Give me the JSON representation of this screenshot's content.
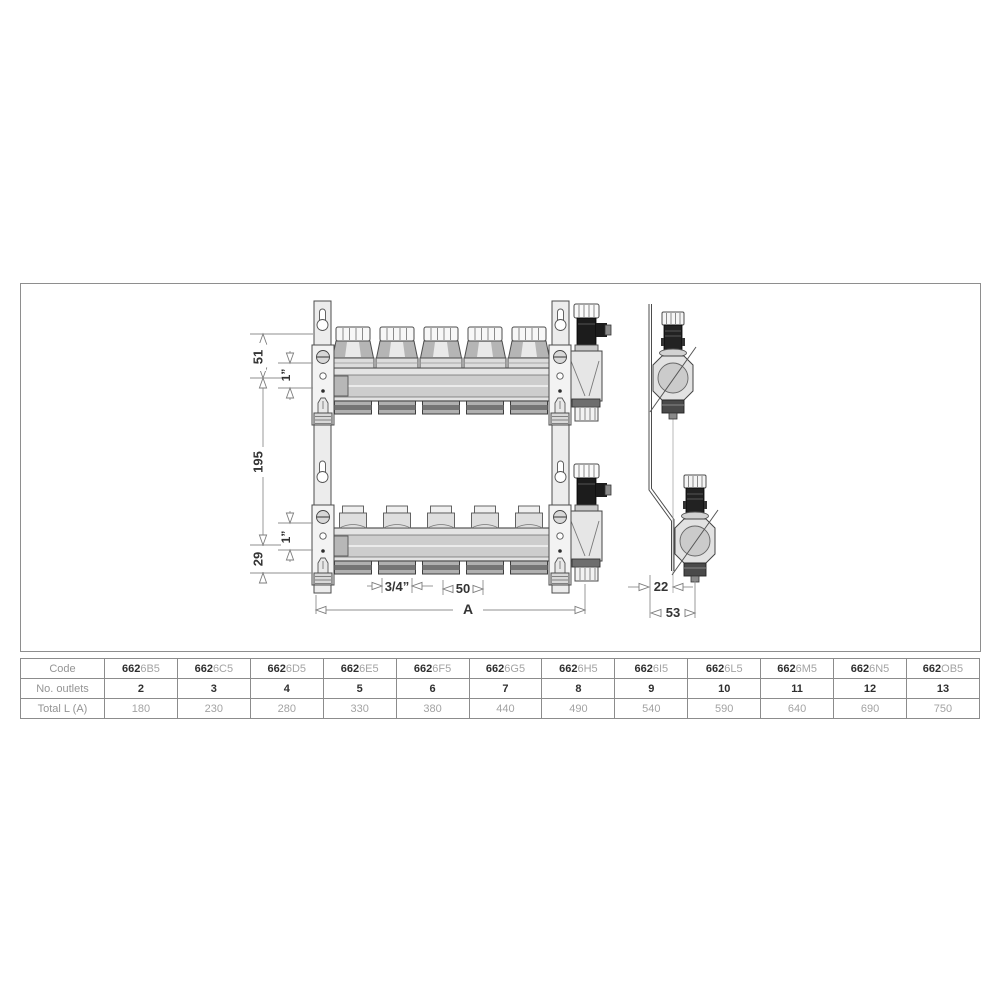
{
  "drawing": {
    "dims": {
      "d51": "51",
      "d1_top": "1”",
      "d195": "195",
      "d29": "29",
      "d1_bottom": "1”",
      "d34": "3/4”",
      "d50": "50",
      "dA": "A",
      "d22": "22",
      "d53": "53"
    }
  },
  "table": {
    "row_labels": {
      "code": "Code",
      "outlets": "No. outlets",
      "total": "Total L (A)"
    },
    "code_prefix": "662",
    "columns": [
      {
        "code_suffix": "6B5",
        "outlets": "2",
        "total": "180"
      },
      {
        "code_suffix": "6C5",
        "outlets": "3",
        "total": "230"
      },
      {
        "code_suffix": "6D5",
        "outlets": "4",
        "total": "280"
      },
      {
        "code_suffix": "6E5",
        "outlets": "5",
        "total": "330"
      },
      {
        "code_suffix": "6F5",
        "outlets": "6",
        "total": "380"
      },
      {
        "code_suffix": "6G5",
        "outlets": "7",
        "total": "440"
      },
      {
        "code_suffix": "6H5",
        "outlets": "8",
        "total": "490"
      },
      {
        "code_suffix": "6I5",
        "outlets": "9",
        "total": "540"
      },
      {
        "code_suffix": "6L5",
        "outlets": "10",
        "total": "590"
      },
      {
        "code_suffix": "6M5",
        "outlets": "11",
        "total": "640"
      },
      {
        "code_suffix": "6N5",
        "outlets": "12",
        "total": "690"
      },
      {
        "code_suffix": "OB5",
        "outlets": "13",
        "total": "750"
      }
    ]
  },
  "colors": {
    "outline": "#4d4d4d",
    "dim_line": "#8f8f8f",
    "dim_text": "#343434",
    "table_border": "#8c8c8c",
    "gray_text": "#a3a3a3",
    "metal_light": "#ececec",
    "metal_mid": "#cdcdcd",
    "black_part": "#1c1c1c"
  }
}
